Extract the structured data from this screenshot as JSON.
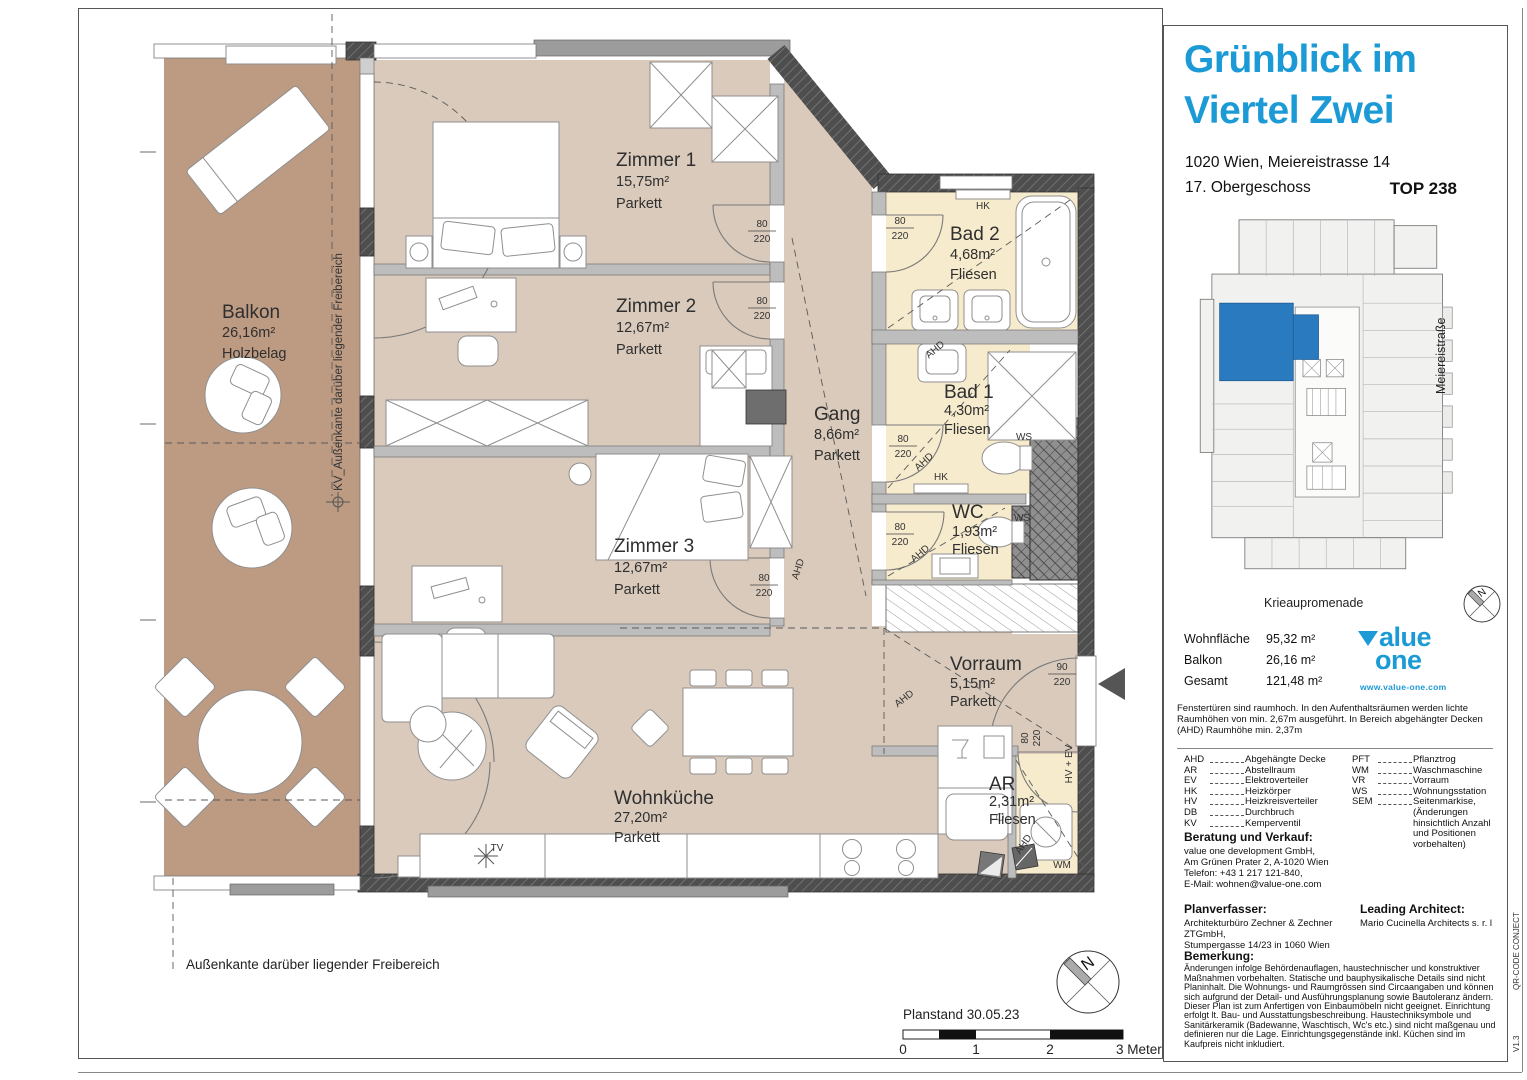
{
  "panel": {
    "title_line1": "Grünblick im",
    "title_line2": "Viertel Zwei",
    "address": "1020 Wien, Meiereistrasse 14",
    "floor": "17. Obergeschoss",
    "unit": "TOP 238",
    "minimap": {
      "street_right": "Meiereistraße",
      "street_bottom": "Krieaupromenade",
      "compass": "N",
      "highlight_color": "#2a7abf"
    },
    "areas": [
      {
        "label": "Wohnfläche",
        "value": "95,32 m²"
      },
      {
        "label": "Balkon",
        "value": "26,16 m²"
      },
      {
        "label": "Gesamt",
        "value": "121,48 m²"
      }
    ],
    "logo": {
      "word1": "alue",
      "word2": "one",
      "url": "www.value-one.com",
      "color": "#1c9ad6"
    },
    "note": "Fenstertüren sind raumhoch. In den Aufenthaltsräumen werden lichte Raumhöhen von min. 2,67m ausgeführt. In Bereich abgehängter Decken (AHD) Raumhöhe min. 2,37m",
    "legend_col1": [
      [
        "AHD",
        "Abgehängte Decke"
      ],
      [
        "AR",
        "Abstellraum"
      ],
      [
        "EV",
        "Elektroverteiler"
      ],
      [
        "HK",
        "Heizkörper"
      ],
      [
        "HV",
        "Heizkreisverteiler"
      ],
      [
        "DB",
        "Durchbruch"
      ],
      [
        "KV",
        "Kemperventil"
      ]
    ],
    "legend_col2": [
      [
        "PFT",
        "Pflanztrog"
      ],
      [
        "WM",
        "Waschmaschine"
      ],
      [
        "VR",
        "Vorraum"
      ],
      [
        "WS",
        "Wohnungsstation"
      ],
      [
        "SEM",
        "Seitenmarkise, (Änderungen hinsichtlich Anzahl und Positionen vorbehalten)"
      ]
    ],
    "contact_heading": "Beratung und Verkauf:",
    "contact_lines": [
      "value one development GmbH,",
      "Am Grünen Prater 2, A-1020 Wien",
      "Telefon: +43 1 217 121-840,",
      "E-Mail: wohnen@value-one.com"
    ],
    "planner_heading": "Planverfasser:",
    "planner_line1": "Architekturbüro Zechner & Zechner ZTGmbH,",
    "planner_line2": "Stumpergasse 14/23 in 1060 Wien",
    "architect_heading": "Leading Architect:",
    "architect_line": "Mario Cucinella Architects s. r. l",
    "remark_heading": "Bemerkung:",
    "remark_text": "Änderungen infolge Behördenauflagen, haustechnischer und konstruktiver Maßnahmen vorbehalten. Statische und bauphysikalische Details sind nicht Planinhalt. Die Wohnungs- und Raumgrössen sind Circaangaben und können sich aufgrund der Detail- und Ausführungsplanung sowie Bautoleranz ändern. Dieser Plan ist zum Anfertigen von Einbaumöbeln nicht geeignet. Einrichtung erfolgt lt. Bau- und Ausstattungsbeschreibung. Haustechniksymbole und Sanitärkeramik (Badewanne, Waschtisch, Wc's etc.) sind nicht maßgenau und definieren nur die Lage. Einrichtungsgegenstände inkl. Küchen sind im Kaufpreis nicht inkludiert.",
    "side_vertical_top": "QR-CODE CONJECT",
    "side_vertical_bottom": "V1.3"
  },
  "plan": {
    "rooms": [
      {
        "name": "Zimmer 1",
        "area": "15,75m²",
        "floor": "Parkett"
      },
      {
        "name": "Zimmer 2",
        "area": "12,67m²",
        "floor": "Parkett"
      },
      {
        "name": "Zimmer 3",
        "area": "12,67m²",
        "floor": "Parkett"
      },
      {
        "name": "Gang",
        "area": "8,66m²",
        "floor": "Parkett"
      },
      {
        "name": "Bad 2",
        "area": "4,68m²",
        "floor": "Fliesen"
      },
      {
        "name": "Bad 1",
        "area": "4,30m²",
        "floor": "Fliesen"
      },
      {
        "name": "WC",
        "area": "1,93m²",
        "floor": "Fliesen"
      },
      {
        "name": "Vorraum",
        "area": "5,15m²",
        "floor": "Parkett"
      },
      {
        "name": "Wohnküche",
        "area": "27,20m²",
        "floor": "Parkett"
      },
      {
        "name": "AR",
        "area": "2,31m²",
        "floor": "Fliesen"
      },
      {
        "name": "Balkon",
        "area": "26,16m²",
        "floor": "Holzbelag"
      }
    ],
    "labels": {
      "hk": "HK",
      "ws": "WS",
      "wm": "WM",
      "tv": "TV",
      "ahd": "AHD",
      "hv_ev": "HV + EV",
      "door_w": "80",
      "door_w_entry": "90",
      "door_h": "220",
      "north": "N"
    },
    "annotations": {
      "balcony_edge_vertical": "KV_Außenkante darüber liegender Freibereich",
      "balcony_edge_bottom": "Außenkante darüber liegender Freibereich",
      "plan_date": "Planstand 30.05.23",
      "scale_0": "0",
      "scale_1": "1",
      "scale_2": "2",
      "scale_3": "3 Meter"
    }
  }
}
